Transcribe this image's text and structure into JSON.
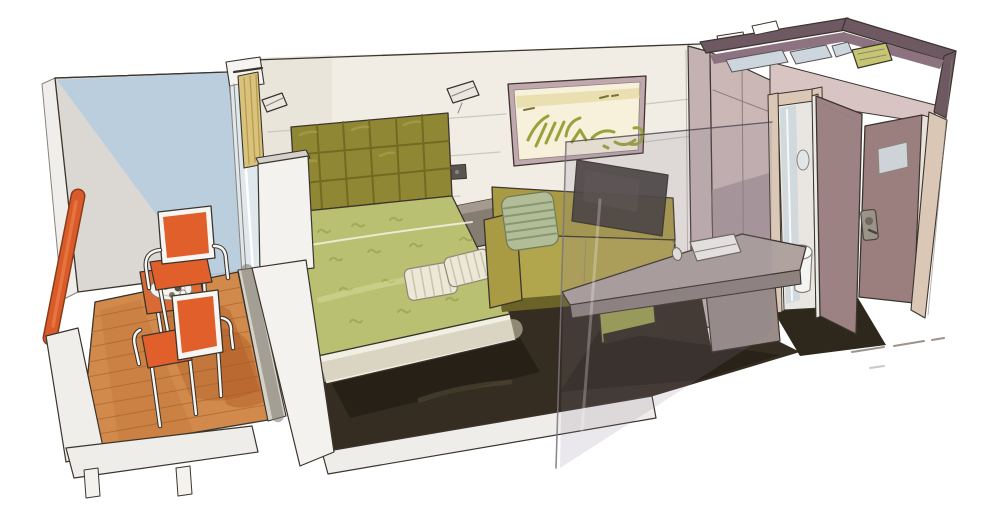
{
  "illustration": {
    "subject": "Hand-drawn cutaway rendering of a cruise ship balcony cabin",
    "style": "marker and watercolor sketch on white background",
    "areas": {
      "balcony": [
        "orange handrail",
        "teak deck planks",
        "two orange armchairs",
        "bistro table",
        "tea tray with pot and cups",
        "sliding-door track"
      ],
      "bedroom": [
        "tufted olive headboard",
        "double bed with green patterned spread",
        "two striped pillows",
        "pleated bed skirt",
        "two wall reading lamps",
        "wall switch",
        "nightstand",
        "framed abstract artwork",
        "olive sofa with sage striped cushion",
        "wall-mounted tv on glass partition",
        "writing desk with notebook and mouse",
        "olive stool",
        "dark carpet"
      ],
      "entry_and_bathroom": [
        "wardrobe",
        "bathroom doorway with shower glass, toilet and oval mirror",
        "open bathroom door",
        "open entry door with sign plate and handle",
        "plum ceiling parapet seen from above",
        "glass shower partitions from above",
        "green ceiling fixture"
      ]
    }
  },
  "colors": {
    "background": "#ffffff",
    "outline": "#3b352d",
    "wall_cream": "#f1ede5",
    "wall_shade": "#e6e1d7",
    "balcony_wall_gray": "#dbd8d3",
    "sky_blue": "#b7cddf",
    "handrail_orange": "#d95b2b",
    "handrail_dark": "#8a3c16",
    "deck_wood": "#d28a4c",
    "deck_shadow": "#b05a24",
    "chair_orange": "#e05f2a",
    "chair_frame": "#f7f6f3",
    "table_orange": "#d96a35",
    "tray_white": "#f4f2ec",
    "track_gray": "#d6d1c6",
    "curtain_tan": "#d9c27c",
    "glass_blue": "#dfe8ec",
    "pillar_white": "#f4f2ee",
    "slab_white": "#efedea",
    "headboard_olive": "#8f8733",
    "headboard_dark": "#6d661f",
    "bed_green": "#b9c072",
    "bed_fold_green": "#a3ad5c",
    "bed_pattern": "#9aa74e",
    "skirt_cream": "#f1eee2",
    "pillow_cream": "#ece8d8",
    "carpet_dark": "#352d21",
    "entry_floor": "#2e281c",
    "sofa_olive": "#a89b44",
    "sofa_seat": "#b1a54d",
    "sofa_base_dark": "#6b6228",
    "sofa_pillow_sage": "#b2bc96",
    "tv_dark": "#413b36",
    "nightstand_taupe": "#857c72",
    "artwork_frame": "#c0a8ae",
    "artwork_mat": "#f7f1dc",
    "artwork_gold": "#e3d79e",
    "artwork_stroke": "#9aa13b",
    "desk_taupe": "#b0a39f",
    "desk_front": "#8f827e",
    "desk_leg": "#9a8d89",
    "stool_olive": "#9aa04e",
    "closet_side": "#c4b2b2",
    "closet_pink": "#cbb7b5",
    "closet_lower": "#a08f93",
    "door_mauve": "#9c8282",
    "entry_door_mauve": "#9b7f7f",
    "door_frame_beige": "#dac7b5",
    "header_pink": "#d8c5c3",
    "parapet_plum": "#6e5862",
    "parapet_inner": "#8d7380",
    "bath_glass": "#ccd6dc",
    "fixture_green": "#c6c672",
    "sign_plate": "#cdd3d7",
    "glass_tint": "rgba(140,130,150,0.18)"
  }
}
